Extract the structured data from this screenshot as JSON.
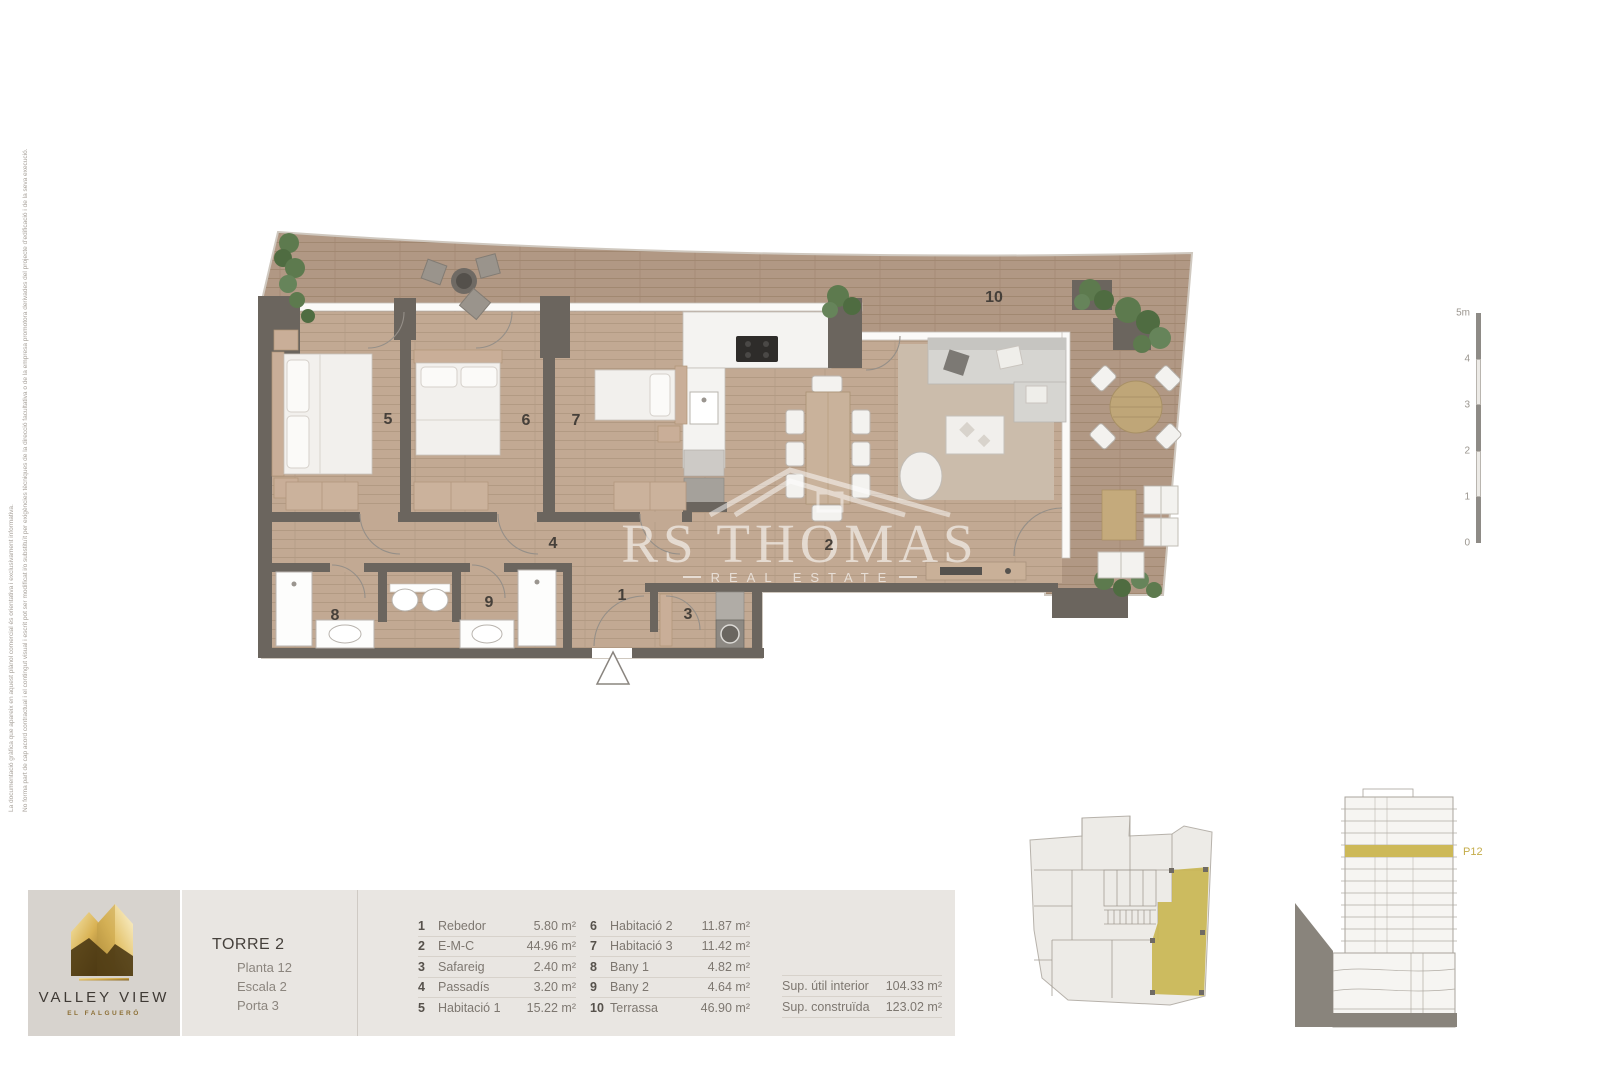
{
  "disclaimer": {
    "line1": "La documentació gràfica que apareix en aquest plànol comercial és orientativa i exclusivament informativa.",
    "line2": "No forma part de cap acord contractual i el contingut visual i escrit pot ser modificat i/o substituït per exigències tècniques de la direcció facultativa o de la empresa promotora derivades del projecte d'edificació i de la seva execució."
  },
  "watermark": {
    "name": "RS THOMAS",
    "tagline": "REAL ESTATE"
  },
  "plan": {
    "room_labels": {
      "rebedor": "1",
      "emc": "2",
      "safareig": "3",
      "passadis": "4",
      "habitacio1": "5",
      "habitacio2": "6",
      "habitacio3": "7",
      "bany1": "8",
      "bany2": "9",
      "terrassa": "10"
    }
  },
  "scale_bar": {
    "labels": [
      "5m",
      "4",
      "3",
      "2",
      "1",
      "0"
    ]
  },
  "elevation": {
    "floor_label": "P12"
  },
  "branding": {
    "logo_title": "VALLEY VIEW",
    "logo_subtitle": "EL FALGUERÓ"
  },
  "unit_info": {
    "tower": "TORRE 2",
    "floor": "Planta 12",
    "stair": "Escala 2",
    "door": "Porta 3"
  },
  "legend": {
    "rows": [
      {
        "num": "1",
        "name": "Rebedor",
        "area": "5.80 m²"
      },
      {
        "num": "2",
        "name": "E-M-C",
        "area": "44.96 m²"
      },
      {
        "num": "3",
        "name": "Safareig",
        "area": "2.40 m²"
      },
      {
        "num": "4",
        "name": "Passadís",
        "area": "3.20 m²"
      },
      {
        "num": "5",
        "name": "Habitació 1",
        "area": "15.22 m²"
      },
      {
        "num": "6",
        "name": "Habitació 2",
        "area": "11.87 m²"
      },
      {
        "num": "7",
        "name": "Habitació 3",
        "area": "11.42 m²"
      },
      {
        "num": "8",
        "name": "Bany 1",
        "area": "4.82 m²"
      },
      {
        "num": "9",
        "name": "Bany 2",
        "area": "4.64 m²"
      },
      {
        "num": "10",
        "name": "Terrassa",
        "area": "46.90 m²"
      }
    ],
    "summary": [
      {
        "label": "Sup. útil interior",
        "value": "104.33 m²"
      },
      {
        "label": "Sup. construïda",
        "value": "123.02 m²"
      }
    ]
  },
  "colors": {
    "accent_gold": "#c9b654",
    "wall": "#6b655e",
    "terrace_floor": "#b19884",
    "interior_floor": "#c2a993",
    "watermark": "#ffffff"
  }
}
